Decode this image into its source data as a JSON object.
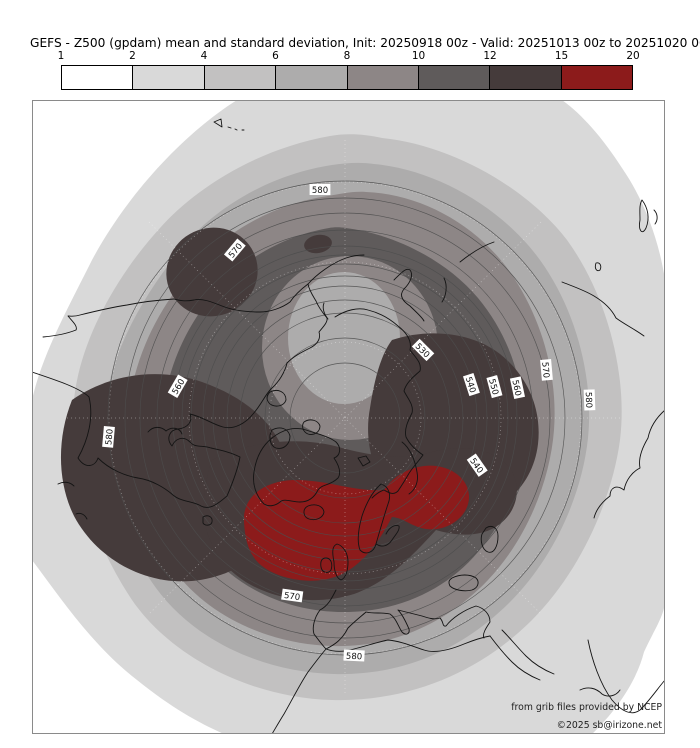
{
  "title": "GEFS - Z500 (gpdam) mean and standard deviation, Init: 20250918 00z - Valid: 20251013 00z to 20251020 00z",
  "colorbar": {
    "ticks": [
      "1",
      "2",
      "4",
      "6",
      "8",
      "10",
      "12",
      "15",
      "20"
    ],
    "bins": [
      {
        "range": "1-2",
        "color": "#ffffff"
      },
      {
        "range": "2-4",
        "color": "#d9d9d9"
      },
      {
        "range": "4-6",
        "color": "#c2c1c1"
      },
      {
        "range": "6-8",
        "color": "#adacac"
      },
      {
        "range": "8-10",
        "color": "#8d8686"
      },
      {
        "range": "10-12",
        "color": "#5f5b5b"
      },
      {
        "range": "12-15",
        "color": "#453b3b"
      },
      {
        "range": "15-20",
        "color": "#8c1b1b"
      }
    ]
  },
  "map": {
    "attribution1": "from grib files provided by NCEP",
    "attribution2": "©2025 sb@irizone.net",
    "contour_min": 520,
    "contour_max": 580,
    "contour_interval": 5,
    "contour_labels": [
      {
        "value": "580",
        "x": 288,
        "y": 91,
        "rot": 0
      },
      {
        "value": "570",
        "x": 204,
        "y": 151,
        "rot": -50
      },
      {
        "value": "560",
        "x": 147,
        "y": 287,
        "rot": -60
      },
      {
        "value": "580",
        "x": 78,
        "y": 337,
        "rot": -85
      },
      {
        "value": "530",
        "x": 390,
        "y": 251,
        "rot": 45
      },
      {
        "value": "540",
        "x": 438,
        "y": 285,
        "rot": 72
      },
      {
        "value": "550",
        "x": 461,
        "y": 287,
        "rot": 75
      },
      {
        "value": "560",
        "x": 484,
        "y": 288,
        "rot": 78
      },
      {
        "value": "570",
        "x": 513,
        "y": 270,
        "rot": 85
      },
      {
        "value": "580",
        "x": 556,
        "y": 300,
        "rot": 88
      },
      {
        "value": "540",
        "x": 444,
        "y": 366,
        "rot": 55
      },
      {
        "value": "570",
        "x": 260,
        "y": 497,
        "rot": 8
      },
      {
        "value": "580",
        "x": 322,
        "y": 557,
        "rot": 3
      }
    ]
  }
}
